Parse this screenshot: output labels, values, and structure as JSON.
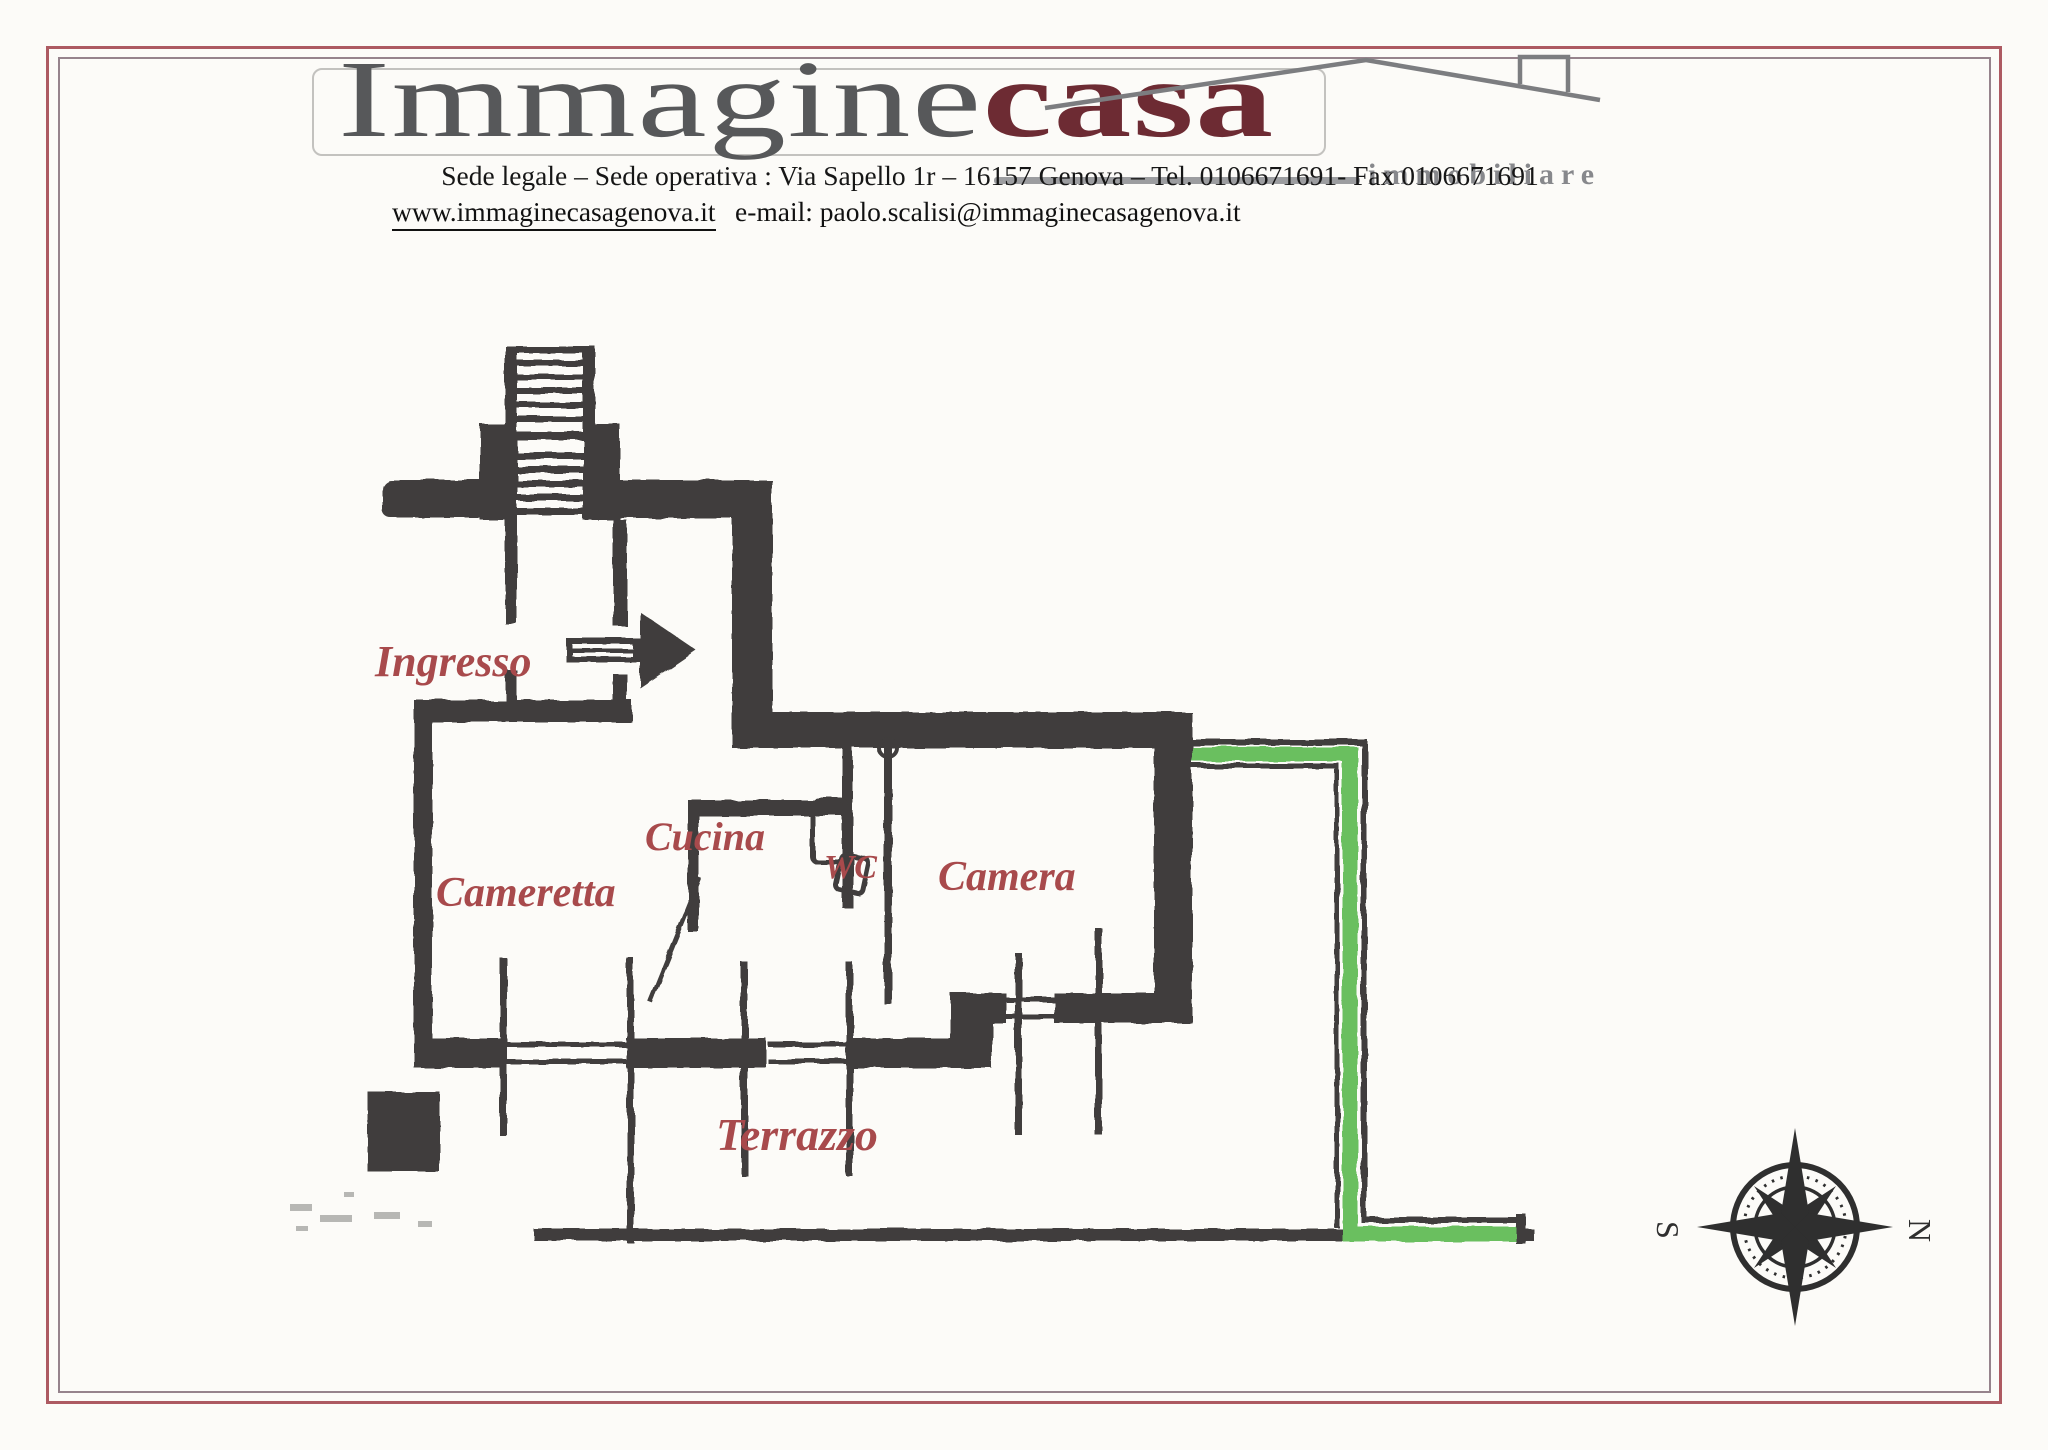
{
  "header": {
    "logo": {
      "part1": "Immagine",
      "part2": "casa",
      "subtitle": "immobiliare"
    },
    "address_line": "Sede legale – Sede operativa : Via Sapello 1r – 16157 Genova – Tel. 0106671691- Fax 0106671691",
    "website": "www.immaginecasagenova.it",
    "email": "e-mail: paolo.scalisi@immaginecasagenova.it"
  },
  "floor_plan": {
    "labels": {
      "ingresso": "Ingresso",
      "cameretta": "Cameretta",
      "cucina": "Cucina",
      "wc": "WC",
      "camera": "Camera",
      "terrazzo": "Terrazzo"
    },
    "compass": {
      "south": "S",
      "north": "N"
    },
    "colors": {
      "wall": "#3f3e3c",
      "highlight_green": "#6abf5e",
      "room_label": "#a84a4c",
      "frame_outer": "#ad5a62",
      "frame_inner": "#96838c",
      "logo_casa": "#6d2b33",
      "logo_gray": "#57585a"
    }
  }
}
